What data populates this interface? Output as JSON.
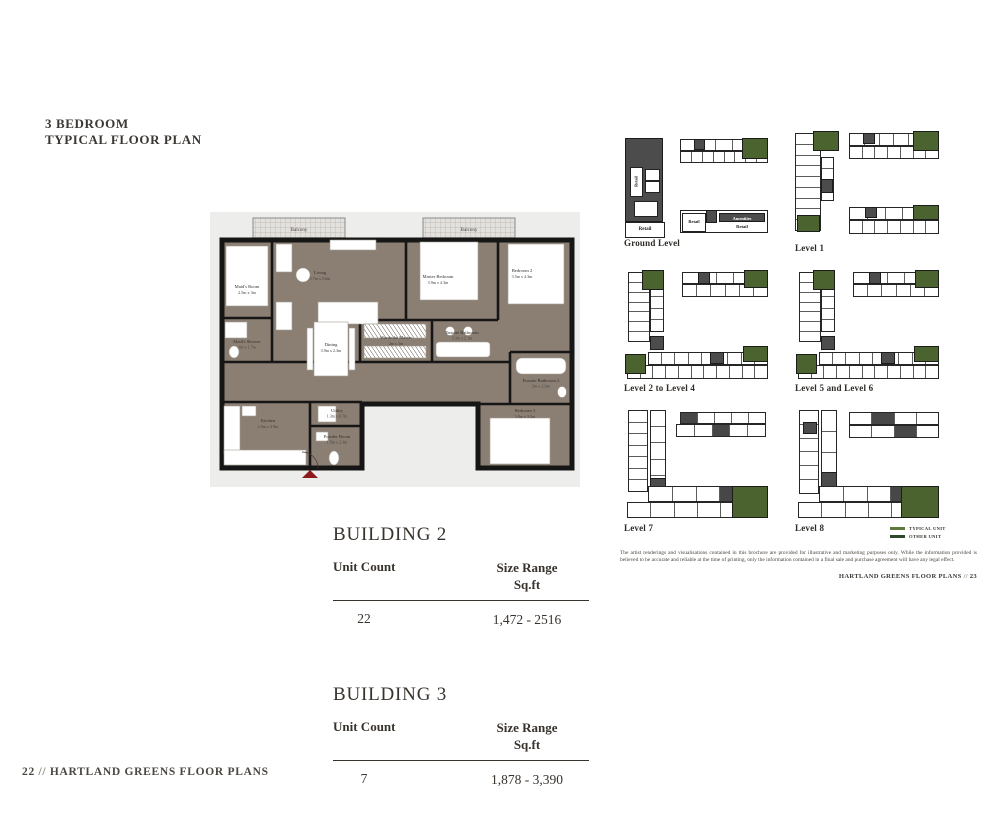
{
  "header": {
    "line1": "3 BEDROOM",
    "line2": "TYPICAL FLOOR PLAN"
  },
  "floorplan": {
    "balcony": "Balcony",
    "rooms": {
      "maids_room": {
        "name": "Maid's Room",
        "dims": "2.5m x 3m"
      },
      "living": {
        "name": "Living",
        "dims": "5.7m x 5.6m"
      },
      "master_bedroom": {
        "name": "Master Bedroom",
        "dims": "3.9m x 4.3m"
      },
      "bedroom2": {
        "name": "Bedroom 2",
        "dims": "3.5m x 4.3m"
      },
      "maids_shower": {
        "name": "Maid's Shower",
        "dims": "1m x 1.7m"
      },
      "dining": {
        "name": "Dining",
        "dims": "3.9m x 2.3m"
      },
      "wardrobe": {
        "name": "Wardrobe Master",
        "dims": "2m x 3m"
      },
      "ensuite": {
        "name": "Ensuite Bathroom",
        "dims": "3.3m x 2.1m"
      },
      "ensuite2": {
        "name": "Ensuite Bathroom 2",
        "dims": "2m x 2.0m"
      },
      "kitchen": {
        "name": "Kitchen",
        "dims": "2.5m x 3.9m"
      },
      "utility": {
        "name": "Utility",
        "dims": "1.3m x 0.7m"
      },
      "powder": {
        "name": "Powder Room",
        "dims": "1.5m x 2.3m"
      },
      "bedroom3": {
        "name": "Bedroom 3",
        "dims": "3.8m x 3.5m"
      }
    }
  },
  "levels": [
    {
      "label": "Ground Level"
    },
    {
      "label": "Level 1"
    },
    {
      "label": "Level 2 to Level 4"
    },
    {
      "label": "Level 5 and Level 6"
    },
    {
      "label": "Level 7"
    },
    {
      "label": "Level 8"
    }
  ],
  "ground": {
    "retail": "Retail",
    "amenities": "Amenities"
  },
  "legend": [
    {
      "label": "TYPICAL UNIT",
      "color": "#5d7a3a"
    },
    {
      "label": "OTHER UNIT",
      "color": "#2c4a28"
    }
  ],
  "disclaimer": "The artist renderings and visualisations contained in this brochure are provided for illustrative and marketing purposes only. While the information provided is believed to be accurate and reliable at the time of printing, only the information contained in a final sale and purchase agreement will have any legal effect.",
  "page_ref_right": {
    "text": "HARTLAND GREENS FLOOR PLANS",
    "sep": "//",
    "num": "23"
  },
  "footer": {
    "num": "22",
    "sep": "//",
    "text": "HARTLAND GREENS FLOOR PLANS"
  },
  "buildings": [
    {
      "name": "BUILDING 2",
      "unit_count_label": "Unit Count",
      "size_range_label": "Size Range",
      "size_unit": "Sq.ft",
      "unit_count": "22",
      "size_range": "1,472 - 2516"
    },
    {
      "name": "BUILDING 3",
      "unit_count_label": "Unit Count",
      "size_range_label": "Size Range",
      "size_unit": "Sq.ft",
      "unit_count": "7",
      "size_range": "1,878 - 3,390"
    }
  ]
}
